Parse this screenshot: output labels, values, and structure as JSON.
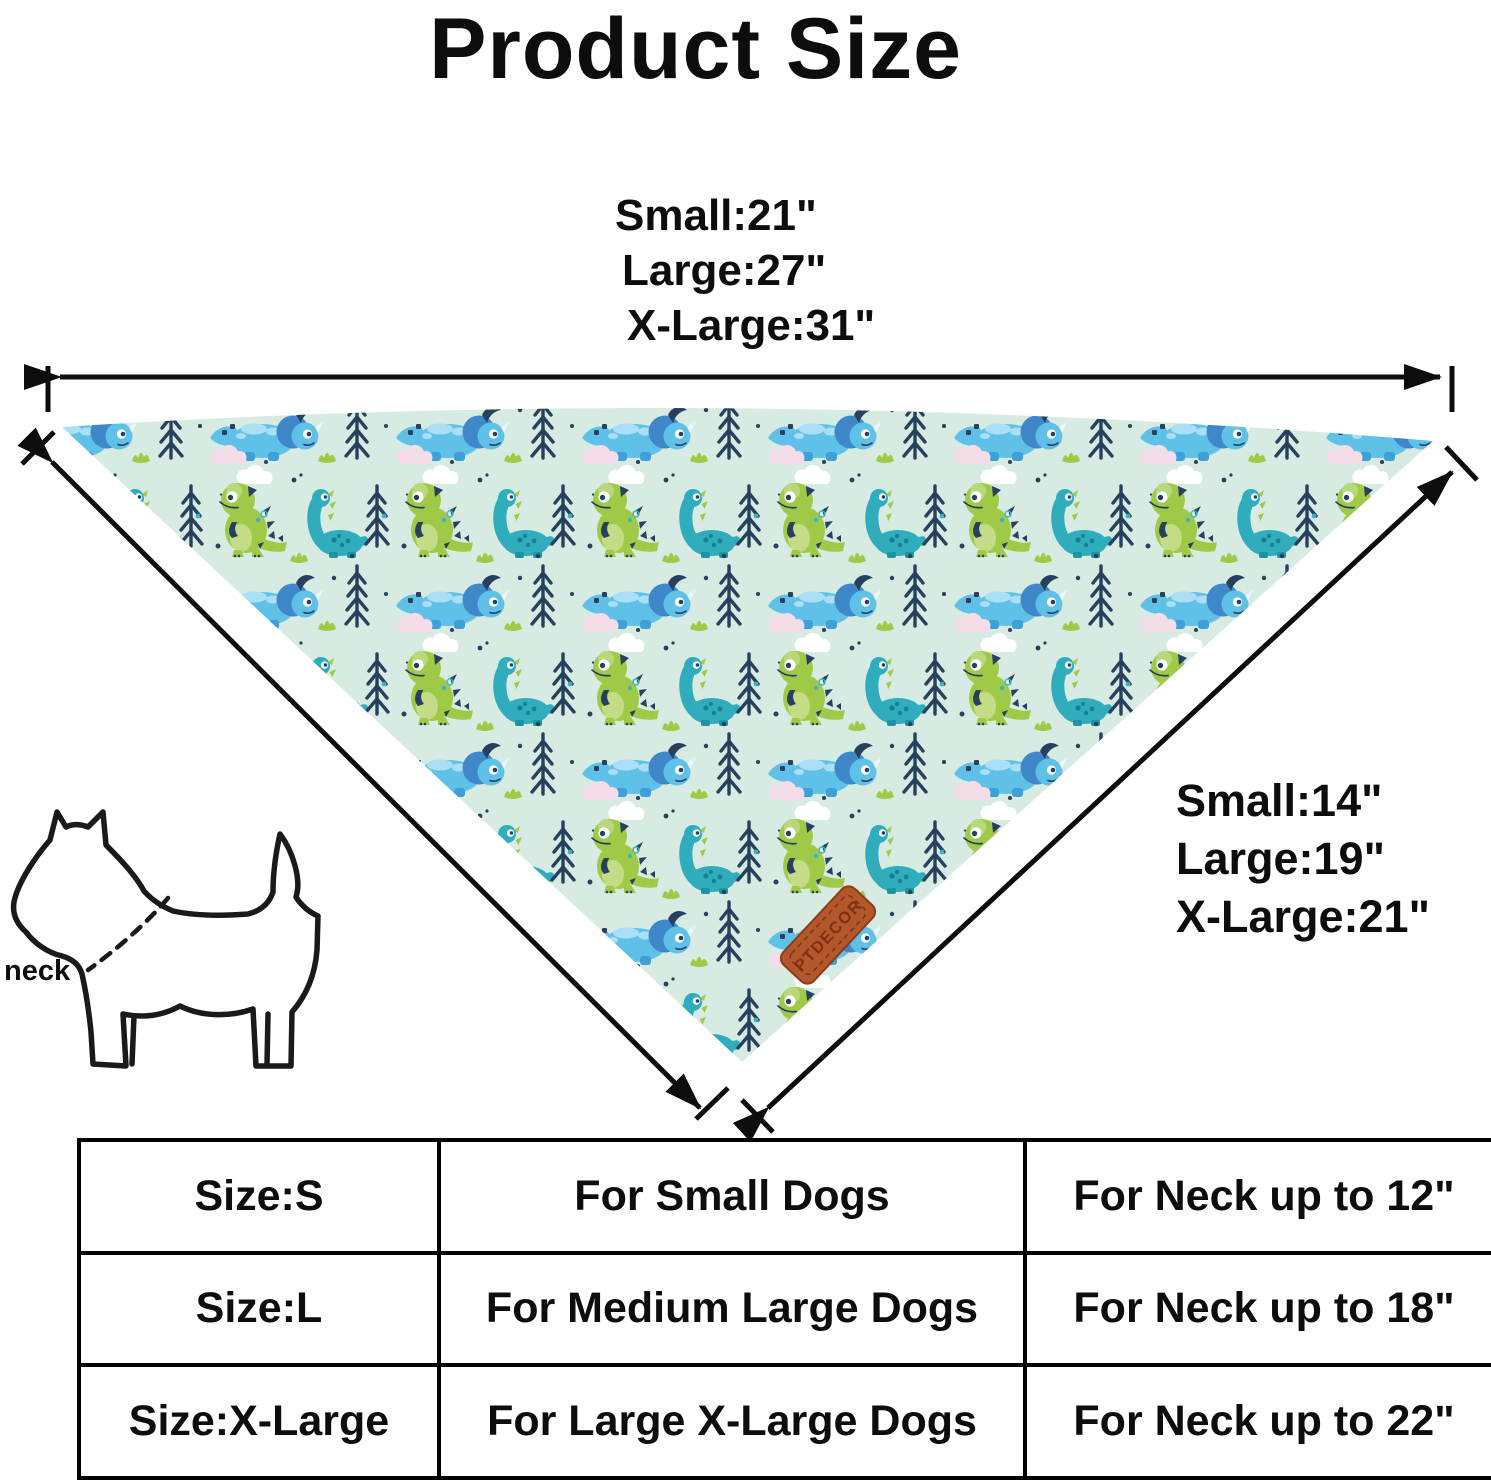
{
  "page_title": "Product Size",
  "measurements": {
    "top_edge": {
      "small": "Small:21\"",
      "large": "Large:27\"",
      "xlarge": "X-Large:31\""
    },
    "side_edge": {
      "small": "Small:14\"",
      "large": "Large:19\"",
      "xlarge": "X-Large:21\""
    }
  },
  "dog_diagram": {
    "neck_label": "neck"
  },
  "bandana": {
    "tag_label": "PTDECOR"
  },
  "size_table": {
    "rows": [
      {
        "size": "Size:S",
        "fits": "For Small Dogs",
        "neck": "For Neck up to 12\""
      },
      {
        "size": "Size:L",
        "fits": "For Medium Large Dogs",
        "neck": "For Neck up to 18\""
      },
      {
        "size": "Size:X-Large",
        "fits": "For Large X-Large Dogs",
        "neck": "For Neck up to 22\""
      }
    ]
  },
  "palette": {
    "fabric_background": "#d7ebe2",
    "dino_blue": "#5fc0e8",
    "dino_blue_dark": "#3e88c9",
    "dino_green": "#9fca47",
    "dino_teal": "#2fadbd",
    "pattern_navy": "#26405e",
    "tag_brown": "#b4582c",
    "line_black": "#0d0d0d"
  }
}
